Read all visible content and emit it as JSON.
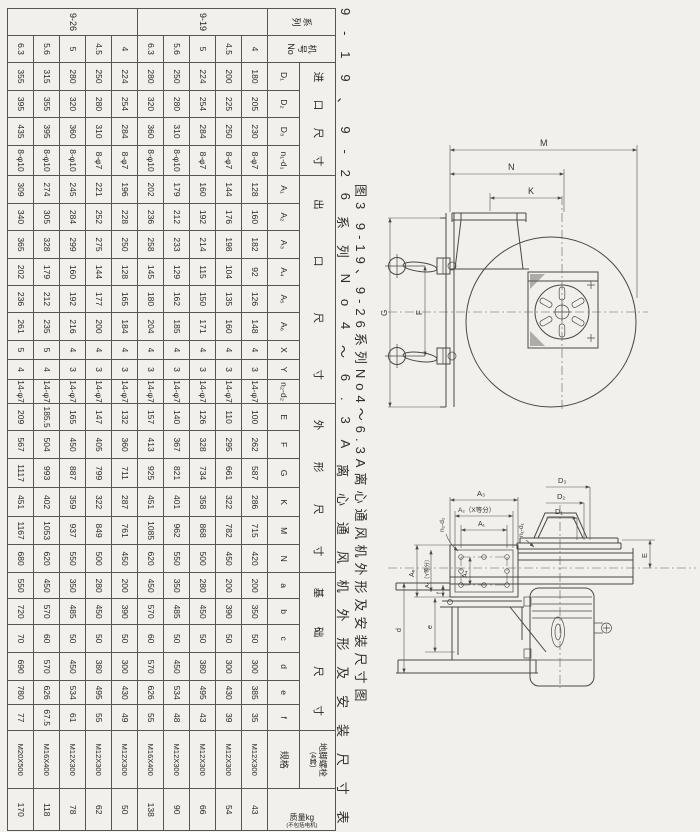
{
  "page": {
    "background": "#f1f0ec"
  },
  "figure_caption": "图3  9-19、9-26系列No4～6.3A离心通风机外形及安装尺寸图",
  "table_caption": "9-19、9-26系列No4～6.3A离心通风机外形及安装尺寸表",
  "spec_table": {
    "series_header_chars": [
      "系",
      "列"
    ],
    "model_header_lines": [
      "机",
      "号",
      "No"
    ],
    "groups": [
      {
        "label": "进口尺寸",
        "cols": [
          "D₁",
          "D₂",
          "D₃",
          "n₁-d₁"
        ]
      },
      {
        "label": "出口尺寸",
        "cols": [
          "A₁",
          "A₂",
          "A₃",
          "A₄",
          "A₅",
          "A₆",
          "X",
          "Y",
          "n₂-d₂"
        ]
      },
      {
        "label": "外形尺寸",
        "cols": [
          "E",
          "F",
          "G",
          "K",
          "M",
          "N"
        ]
      },
      {
        "label": "基础尺寸",
        "cols": [
          "a",
          "b",
          "c",
          "d",
          "e",
          "f"
        ]
      }
    ],
    "bolt_group_label": "地脚螺栓",
    "bolt_group_note": "(4套)",
    "bolt_leaf_label": "规格",
    "mass_header_line1": "质量kg",
    "mass_header_line2": "(不包括电机)",
    "rows": [
      {
        "series": "9-19",
        "no": "4",
        "values": [
          "180",
          "205",
          "230",
          "8-φ7",
          "128",
          "160",
          "182",
          "92",
          "126",
          "148",
          "4",
          "3",
          "14-φ7",
          "100",
          "262",
          "587",
          "286",
          "715",
          "420",
          "200",
          "350",
          "50",
          "300",
          "385",
          "35",
          "M12X300",
          "43"
        ]
      },
      {
        "series": "9-19",
        "no": "4.5",
        "values": [
          "200",
          "225",
          "250",
          "8-φ7",
          "144",
          "176",
          "198",
          "104",
          "135",
          "160",
          "4",
          "3",
          "14-φ7",
          "110",
          "295",
          "661",
          "322",
          "782",
          "450",
          "200",
          "390",
          "50",
          "300",
          "430",
          "39",
          "M12X300",
          "54"
        ]
      },
      {
        "series": "9-19",
        "no": "5",
        "values": [
          "224",
          "254",
          "284",
          "8-φ7",
          "160",
          "192",
          "214",
          "115",
          "150",
          "171",
          "4",
          "3",
          "14-φ7",
          "126",
          "328",
          "734",
          "358",
          "868",
          "500",
          "280",
          "450",
          "50",
          "380",
          "495",
          "43",
          "M12X300",
          "66"
        ]
      },
      {
        "series": "9-19",
        "no": "5.6",
        "values": [
          "250",
          "280",
          "310",
          "8-φ10",
          "179",
          "212",
          "233",
          "129",
          "162",
          "185",
          "4",
          "3",
          "14-φ7",
          "140",
          "367",
          "821",
          "401",
          "962",
          "550",
          "350",
          "485",
          "50",
          "450",
          "534",
          "48",
          "M12X300",
          "90"
        ]
      },
      {
        "series": "9-19",
        "no": "6.3",
        "values": [
          "280",
          "320",
          "360",
          "8-φ10",
          "202",
          "236",
          "258",
          "145",
          "180",
          "204",
          "4",
          "3",
          "14-φ7",
          "157",
          "413",
          "925",
          "451",
          "1085",
          "620",
          "450",
          "570",
          "60",
          "570",
          "626",
          "55",
          "M16X400",
          "138"
        ]
      },
      {
        "series": "9-26",
        "no": "4",
        "values": [
          "224",
          "254",
          "284",
          "8-φ7",
          "196",
          "228",
          "250",
          "128",
          "165",
          "184",
          "4",
          "3",
          "14-φ7",
          "132",
          "360",
          "711",
          "287",
          "761",
          "450",
          "200",
          "390",
          "50",
          "300",
          "430",
          "49",
          "M12X300",
          "50"
        ]
      },
      {
        "series": "9-26",
        "no": "4.5",
        "values": [
          "250",
          "280",
          "310",
          "8-φ7",
          "221",
          "252",
          "275",
          "144",
          "177",
          "200",
          "4",
          "3",
          "14-φ7",
          "147",
          "405",
          "799",
          "322",
          "849",
          "500",
          "280",
          "450",
          "50",
          "380",
          "495",
          "55",
          "M12X300",
          "62"
        ]
      },
      {
        "series": "9-26",
        "no": "5",
        "values": [
          "280",
          "320",
          "360",
          "8-φ10",
          "245",
          "284",
          "299",
          "160",
          "192",
          "216",
          "4",
          "3",
          "14-φ7",
          "165",
          "450",
          "887",
          "359",
          "937",
          "550",
          "350",
          "485",
          "50",
          "450",
          "534",
          "61",
          "M12X300",
          "78"
        ]
      },
      {
        "series": "9-26",
        "no": "5.6",
        "values": [
          "315",
          "355",
          "395",
          "8-φ10",
          "274",
          "305",
          "328",
          "179",
          "212",
          "235",
          "5",
          "4",
          "14-φ7",
          "185.5",
          "504",
          "993",
          "402",
          "1053",
          "620",
          "450",
          "570",
          "60",
          "570",
          "626",
          "67.5",
          "M16X400",
          "118"
        ]
      },
      {
        "series": "9-26",
        "no": "6.3",
        "values": [
          "355",
          "395",
          "435",
          "8-φ10",
          "309",
          "340",
          "365",
          "202",
          "236",
          "261",
          "5",
          "4",
          "14-φ7",
          "209",
          "567",
          "1117",
          "451",
          "1167",
          "680",
          "550",
          "720",
          "70",
          "690",
          "780",
          "77",
          "M20X500",
          "170"
        ]
      }
    ]
  },
  "drawing_top": {
    "labels": {
      "M": "M",
      "N": "N",
      "K": "K",
      "G": "G",
      "F": "F"
    }
  },
  "drawing_bottom": {
    "labels": {
      "A3": "A₃",
      "A2x": "A₂（X等分）",
      "A1": "A₁",
      "n2d2": "n₂-d₂",
      "A6": "A₆",
      "A5y": "A₅（Y等分）",
      "A4": "A₄",
      "f": "f",
      "D3": "D₃",
      "D2": "D₂",
      "D1": "D₁",
      "n1d1": "n₁-d₁",
      "E": "E",
      "d": "d",
      "e": "e"
    }
  }
}
